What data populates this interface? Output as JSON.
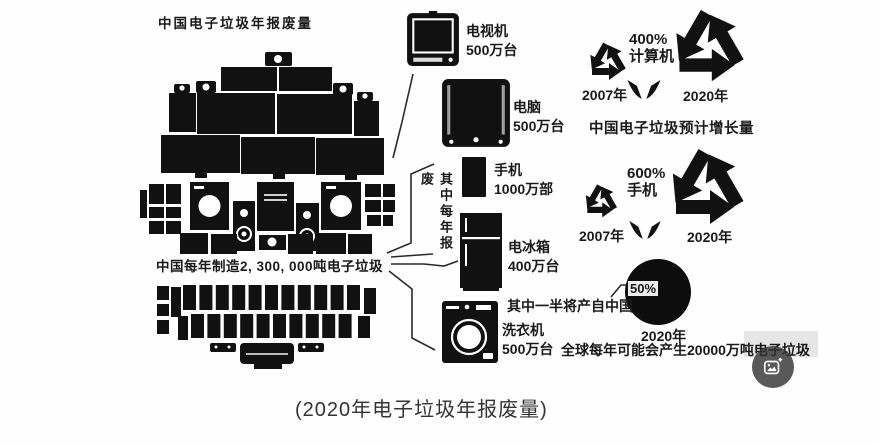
{
  "page": {
    "caption": "(2020年电子垃圾年报废量)"
  },
  "pile": {
    "title": "中国电子垃圾年报废量",
    "note": "中国每年制造2, 300, 000吨电子垃圾"
  },
  "scrapped": {
    "brace_label": "其中每年报废",
    "items": [
      {
        "name": "电视机",
        "qty": "500万台"
      },
      {
        "name": "电脑",
        "qty": "500万台"
      },
      {
        "name": "手机",
        "qty": "1000万部"
      },
      {
        "name": "电冰箱",
        "qty": "400万台"
      },
      {
        "name": "洗衣机",
        "qty": "500万台"
      }
    ]
  },
  "growth": {
    "title": "中国电子垃圾预计增长量",
    "groups": [
      {
        "percent": "400%",
        "category": "计算机",
        "from_year": "2007年",
        "to_year": "2020年"
      },
      {
        "percent": "600%",
        "category": "手机",
        "from_year": "2007年",
        "to_year": "2020年"
      }
    ]
  },
  "global_forecast": {
    "pie_label": "50%",
    "pie_note": "其中一半将产自中国",
    "year": "2020年",
    "note": "全球每年可能会产生20000万吨电子垃圾"
  },
  "icons": {
    "recycle": "recycle-arrows-icon",
    "transform_arrows": "double-arrow-icon",
    "image_button": "image-search-icon"
  },
  "colors": {
    "ink": "#111111",
    "background": "#fefefe",
    "caption_text": "#333333"
  }
}
